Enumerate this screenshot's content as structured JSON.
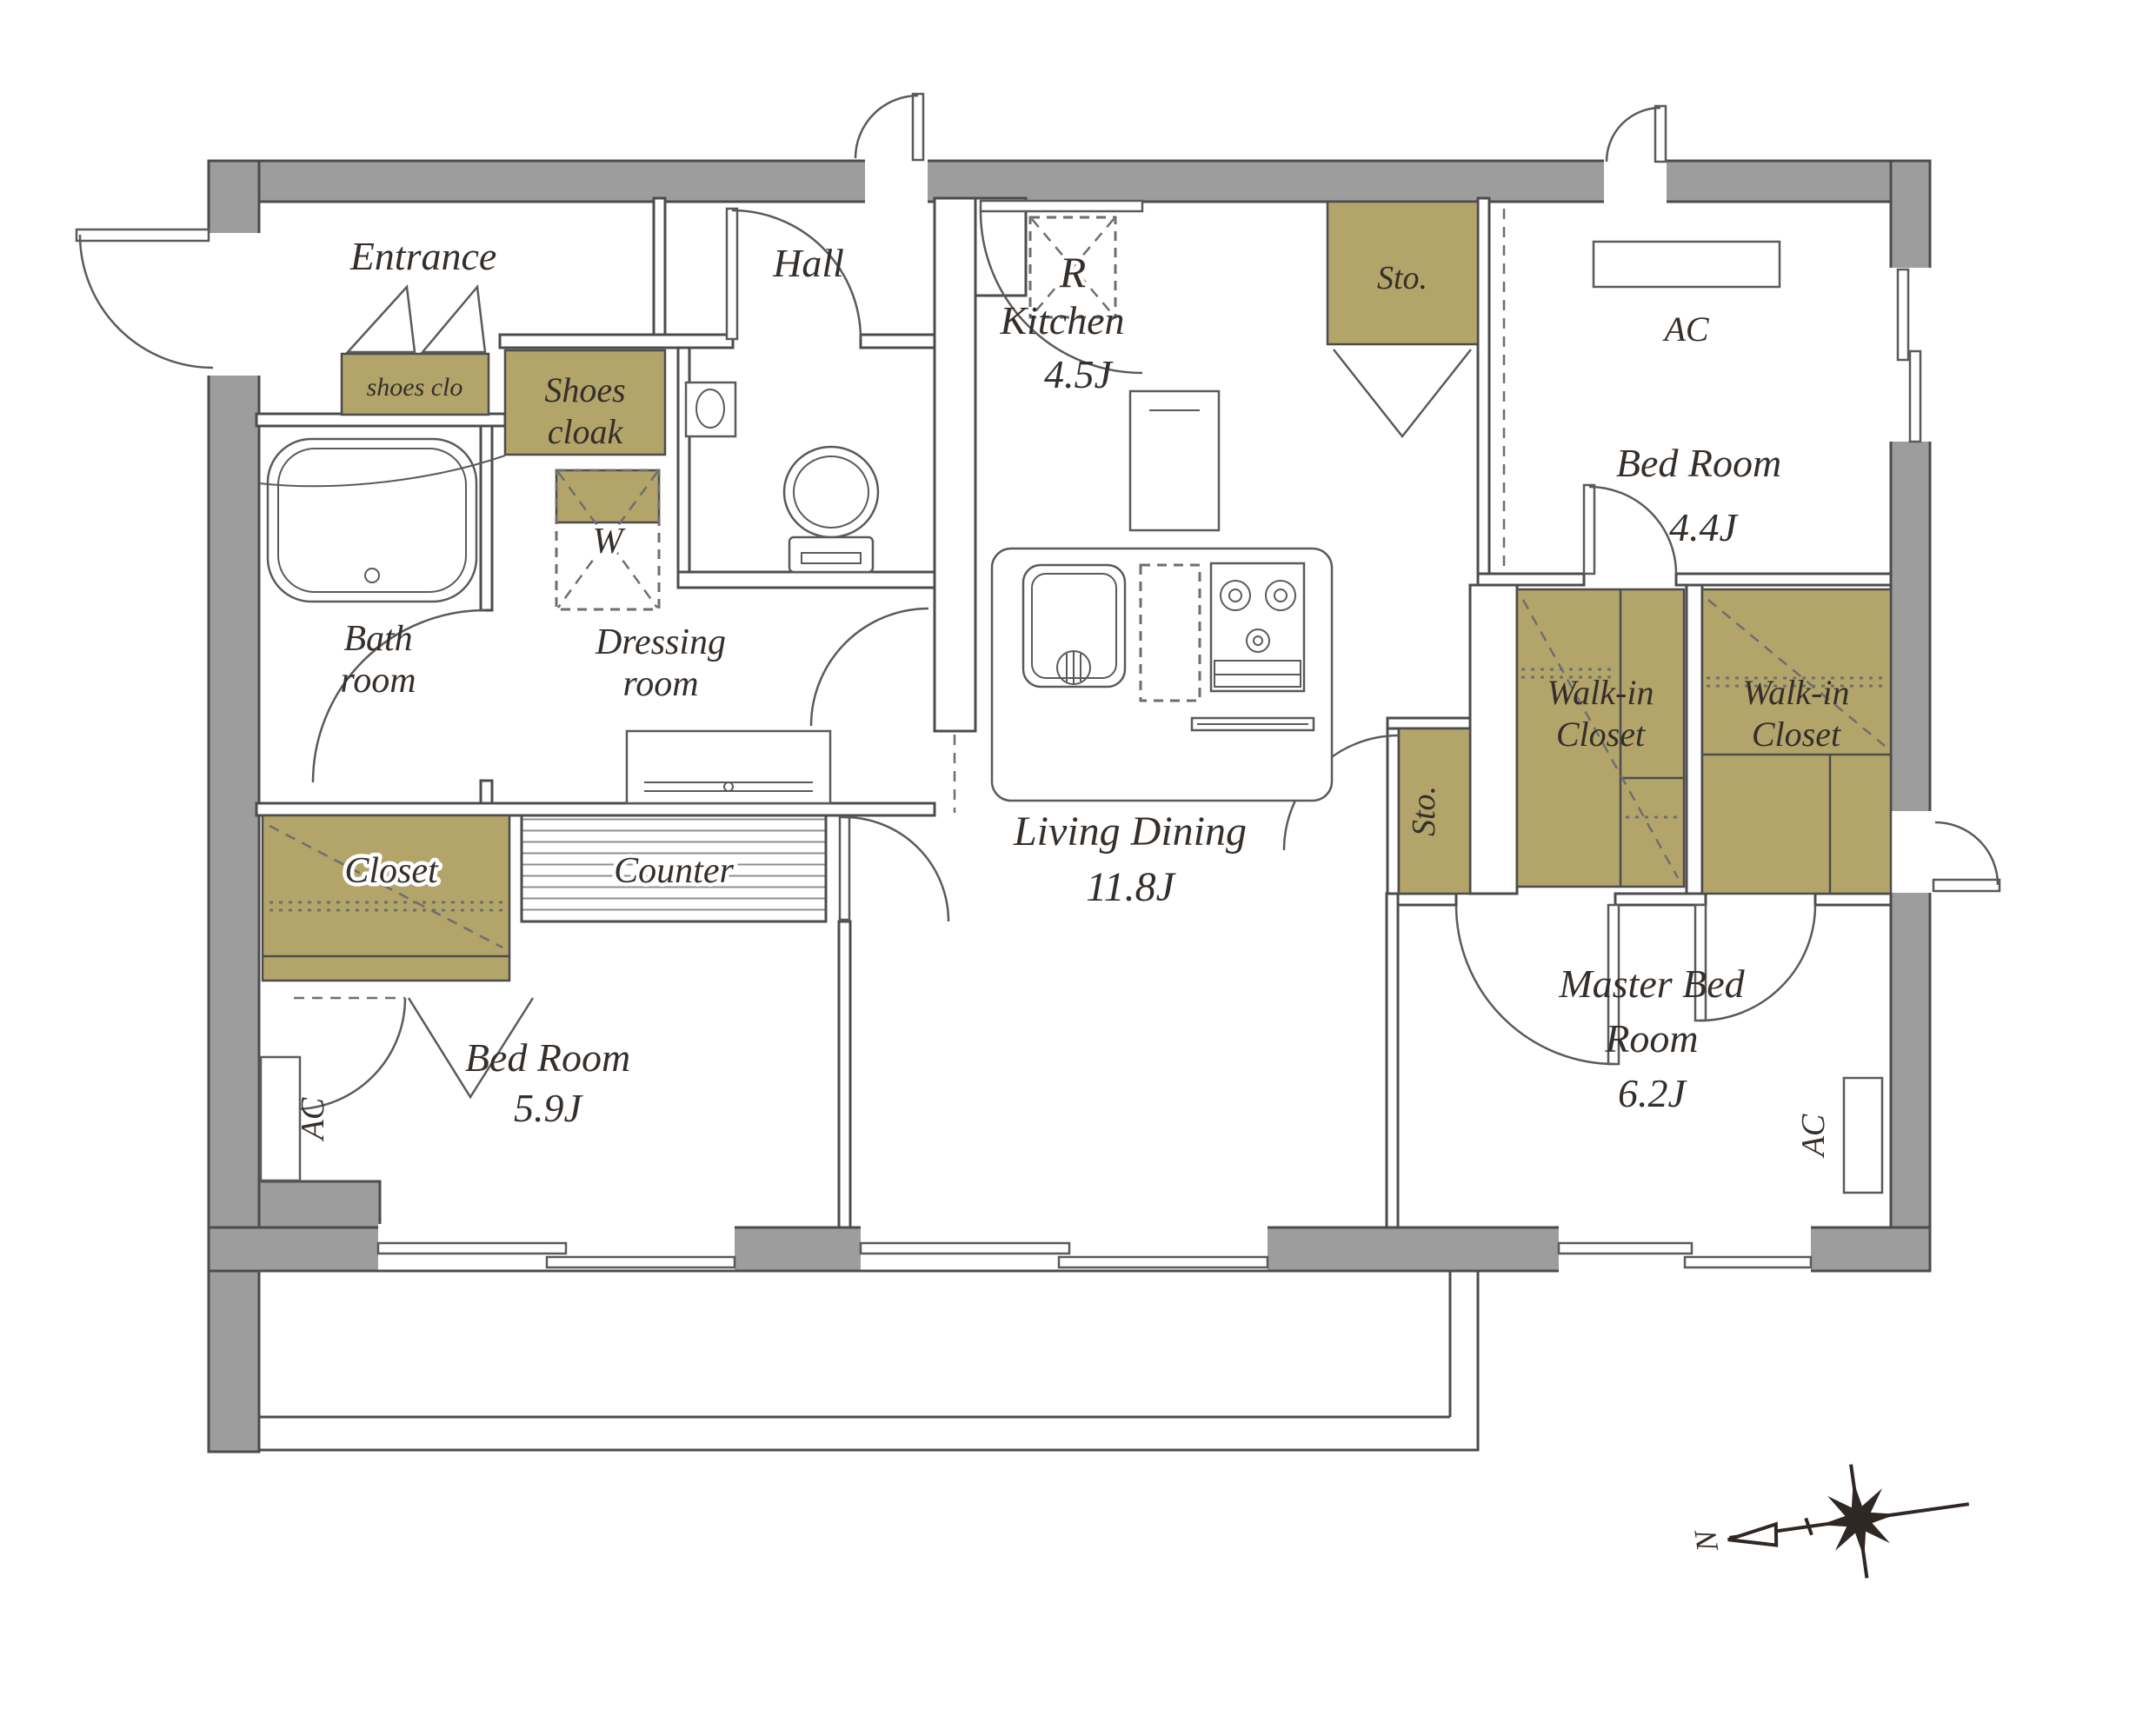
{
  "plan": {
    "rooms": {
      "entrance": {
        "label": "Entrance"
      },
      "hall": {
        "label": "Hall"
      },
      "kitchen": {
        "label": "Kitchen",
        "area": "4.5J"
      },
      "living_dining": {
        "label": "Living Dining",
        "area": "11.8J"
      },
      "bedroom_south": {
        "label": "Bed Room",
        "area": "5.9J"
      },
      "bedroom_north": {
        "label": "Bed Room",
        "area": "4.4J"
      },
      "master_bedroom": {
        "label_line1": "Master Bed",
        "label_line2": "Room",
        "area": "6.2J"
      },
      "bathroom": {
        "label_line1": "Bath",
        "label_line2": "room"
      },
      "dressing_room": {
        "label_line1": "Dressing",
        "label_line2": "room"
      }
    },
    "storage": {
      "closet": {
        "label": "Closet"
      },
      "shoes_cloak": {
        "label_line1": "Shoes",
        "label_line2": "cloak"
      },
      "shoes_clo": {
        "label": "shoes clo"
      },
      "storage_top": {
        "label": "Sto."
      },
      "storage_mid": {
        "label": "Sto."
      },
      "walk_in_closet": {
        "label_line1": "Walk-in",
        "label_line2": "Closet"
      }
    },
    "features": {
      "counter": {
        "label": "Counter"
      },
      "washer": {
        "label": "W"
      },
      "refrigerator": {
        "label": "R"
      },
      "air_conditioner": {
        "label": "AC"
      }
    },
    "compass": {
      "north": "N"
    },
    "colors": {
      "wall": "#9d9d9d",
      "closet": "#b3a46a",
      "line": "#4c4c4c",
      "text": "#352f2b"
    }
  }
}
